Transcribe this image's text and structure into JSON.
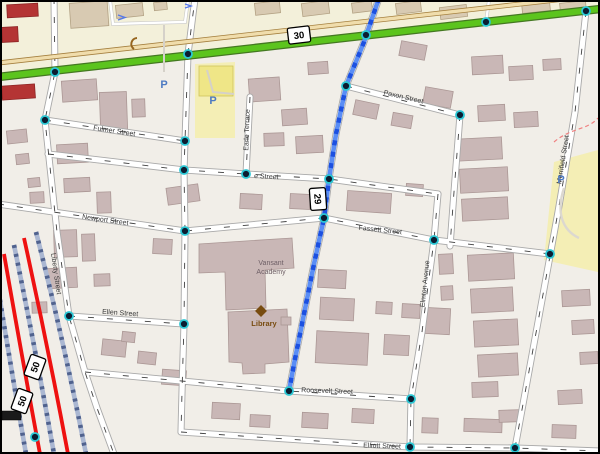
{
  "map": {
    "shields": {
      "route_30": "30",
      "route_29": "29",
      "route_50_a": "50",
      "route_50_b": "50"
    },
    "streets": {
      "fulmer": "Fulmer Street",
      "partial": "e Street",
      "earle": "Earle Terrace",
      "newport": "Newport Street",
      "fassett": "Fassett Street",
      "paxon": "Paxon Street",
      "liberty": "Liberty Street",
      "ellen": "Ellen Street",
      "roosevelt": "Roosevelt Street",
      "elliott": "Elliott Street",
      "elmton": "Elmton Avenue",
      "merrifield": "Merrifield Street"
    },
    "pois": {
      "academy_line1": "Vansant",
      "academy_line2": "Academy",
      "library": "Library",
      "parking_symbol": "P"
    },
    "colors": {
      "route_primary_green": "#5cc41d",
      "selected_route_blue": "#1c50e0",
      "route_50_red": "#ee1111",
      "building_fill": "#c9b7b6",
      "railway_blue_gray": "#aab7d2",
      "node_ring_cyan": "#2bc8d5"
    }
  }
}
